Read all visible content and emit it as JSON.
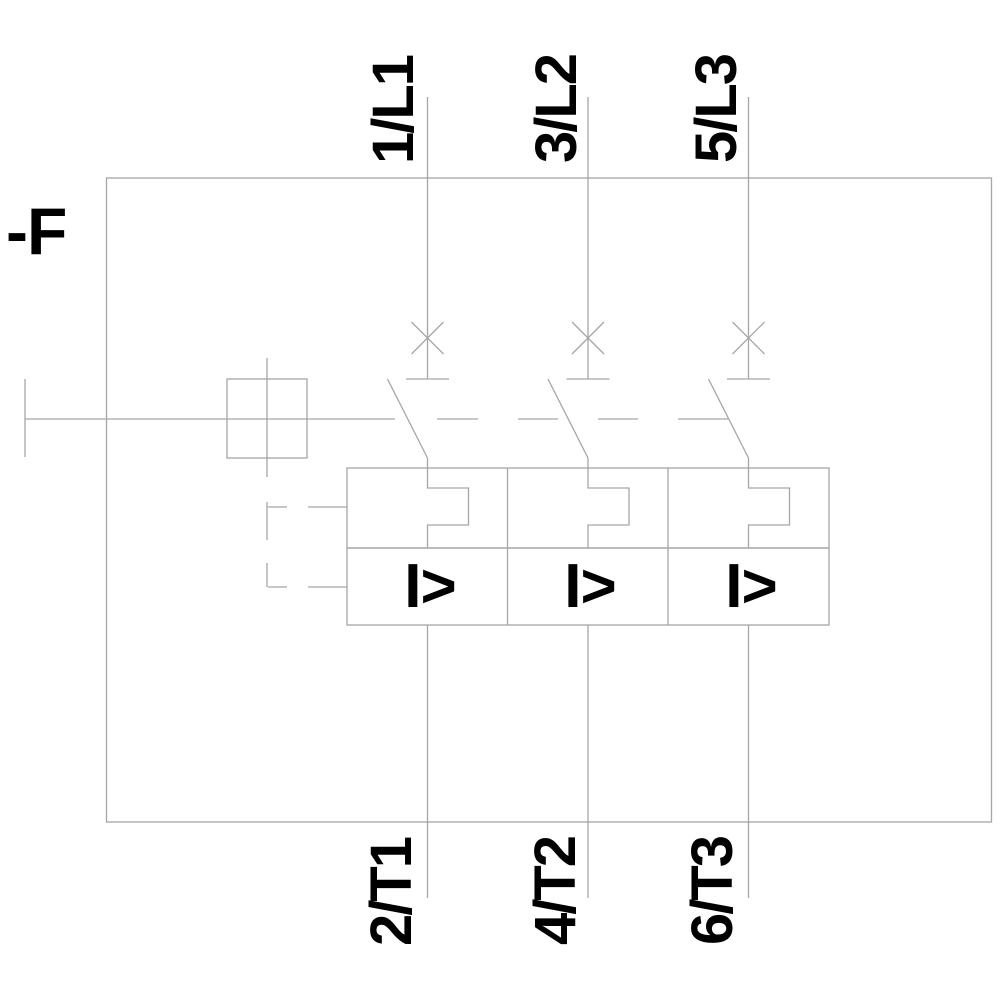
{
  "device": {
    "label": "-F",
    "type_description": "3-pole motor starter protector schematic symbol"
  },
  "poles": [
    {
      "top_terminal": "1/L1",
      "bottom_terminal": "2/T1",
      "magnetic_trip_symbol": "I>"
    },
    {
      "top_terminal": "3/L2",
      "bottom_terminal": "4/T2",
      "magnetic_trip_symbol": "I>"
    },
    {
      "top_terminal": "5/L3",
      "bottom_terminal": "6/T3",
      "magnetic_trip_symbol": "I>"
    }
  ],
  "colors": {
    "line": "#a6a6a6",
    "text": "#000000",
    "background": "#ffffff"
  }
}
